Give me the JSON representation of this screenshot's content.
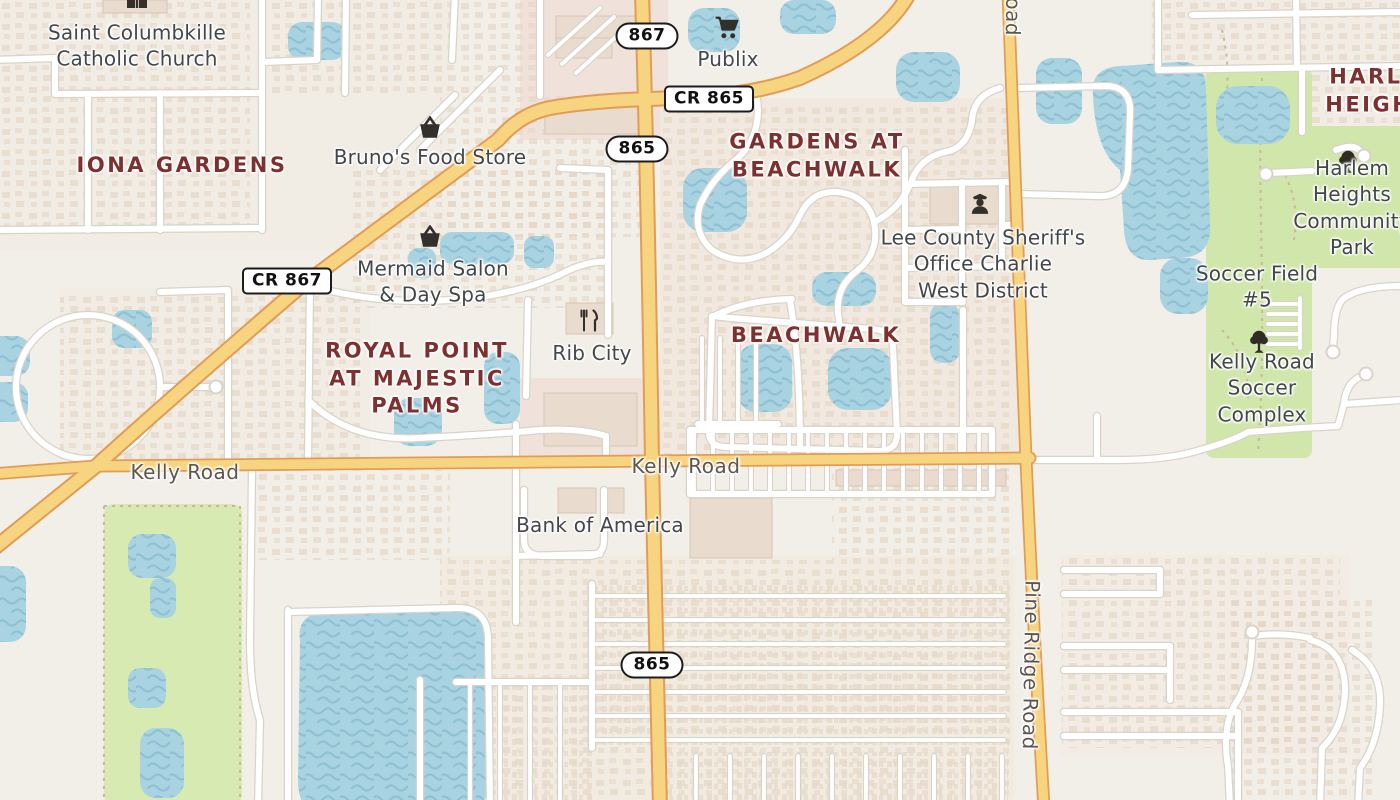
{
  "map": {
    "colors": {
      "land": "#f2eee8",
      "water": "#a9d3e1",
      "water_wave": "#8fc1d4",
      "park_green": "#d0e6aa",
      "golf_green": "#d6eab2",
      "main_road": "#f7d47f",
      "main_road_casing": "#e29c55",
      "minor_road": "#ffffff",
      "minor_road_casing": "#d9d3ca",
      "place_label": "#7e3030",
      "poi_label": "#43474a",
      "road_label": "#5c574e"
    },
    "labels": [
      {
        "id": "saint-columbkille-catholic-church",
        "type": "poi",
        "text": "Saint Columbkille\nCatholic Church",
        "x": 137,
        "y": 46,
        "icon": "church",
        "icon_x": 137,
        "icon_y": 0
      },
      {
        "id": "iona-gardens",
        "type": "place",
        "text": "IONA GARDENS",
        "x": 182,
        "y": 166
      },
      {
        "id": "brunos-food-store",
        "type": "poi",
        "text": "Bruno's Food Store",
        "x": 430,
        "y": 157,
        "icon": "shopping-basket",
        "icon_x": 430,
        "icon_y": 128
      },
      {
        "id": "publix",
        "type": "poi",
        "text": "Publix",
        "x": 728,
        "y": 59,
        "icon": "shopping-cart",
        "icon_x": 727,
        "icon_y": 28
      },
      {
        "id": "gardens-at-beachwalk",
        "type": "place",
        "text": "GARDENS AT\nBEACHWALK",
        "x": 817,
        "y": 156
      },
      {
        "id": "lee-county-sheriffs-office",
        "type": "poi",
        "text": "Lee County Sheriff's\nOffice Charlie\nWest District",
        "x": 983,
        "y": 264,
        "icon": "police-officer",
        "icon_x": 980,
        "icon_y": 203
      },
      {
        "id": "harlem-heights",
        "type": "place",
        "text": "HARLEM\nHEIGHTS",
        "x": 1386,
        "y": 91
      },
      {
        "id": "harlem-heights-community-park",
        "type": "poi",
        "text": "Harlem Heights\nCommunity Park",
        "x": 1352,
        "y": 208,
        "icon": "tree",
        "icon_x": 1348,
        "icon_y": 162
      },
      {
        "id": "soccer-field-5",
        "type": "poi",
        "text": "Soccer Field #5",
        "x": 1257,
        "y": 287
      },
      {
        "id": "kelly-road-soccer-complex",
        "type": "poi",
        "text": "Kelly Road Soccer\nComplex",
        "x": 1262,
        "y": 388,
        "icon": "tree",
        "icon_x": 1259,
        "icon_y": 342
      },
      {
        "id": "mermaid-salon-day-spa",
        "type": "poi",
        "text": "Mermaid Salon\n& Day Spa",
        "x": 433,
        "y": 282,
        "icon": "shopping-basket",
        "icon_x": 430,
        "icon_y": 237
      },
      {
        "id": "royal-point-at-majestic-palms",
        "type": "place",
        "text": "ROYAL POINT\nAT MAJESTIC\nPALMS",
        "x": 417,
        "y": 379
      },
      {
        "id": "rib-city",
        "type": "poi",
        "text": "Rib City",
        "x": 592,
        "y": 353,
        "icon": "restaurant",
        "icon_x": 589,
        "icon_y": 321
      },
      {
        "id": "beachwalk",
        "type": "place",
        "text": "BEACHWALK",
        "x": 816,
        "y": 336
      },
      {
        "id": "kelly-road-west",
        "type": "road",
        "text": "Kelly Road",
        "x": 185,
        "y": 472
      },
      {
        "id": "kelly-road-center",
        "type": "road",
        "text": "Kelly Road",
        "x": 686,
        "y": 466
      },
      {
        "id": "bank-of-america",
        "type": "poi",
        "text": "Bank of America",
        "x": 600,
        "y": 525
      },
      {
        "id": "pine-ridge-road",
        "type": "road",
        "text": "Pine Ridge Road",
        "x": 1031,
        "y": 665,
        "rotate": 91
      },
      {
        "id": "road-partial-top",
        "type": "road",
        "text": "Road",
        "x": 1013,
        "y": 10,
        "rotate": 91
      }
    ],
    "shields": [
      {
        "id": "route-867",
        "text": "867",
        "shape": "pill",
        "x": 647,
        "y": 36
      },
      {
        "id": "route-cr-865",
        "text": "CR 865",
        "shape": "rect",
        "x": 709,
        "y": 99
      },
      {
        "id": "route-865-north",
        "text": "865",
        "shape": "pill",
        "x": 637,
        "y": 149
      },
      {
        "id": "route-cr-867",
        "text": "CR 867",
        "shape": "rect",
        "x": 287,
        "y": 281
      },
      {
        "id": "route-865-south",
        "text": "865",
        "shape": "pill",
        "x": 652,
        "y": 665
      }
    ]
  }
}
